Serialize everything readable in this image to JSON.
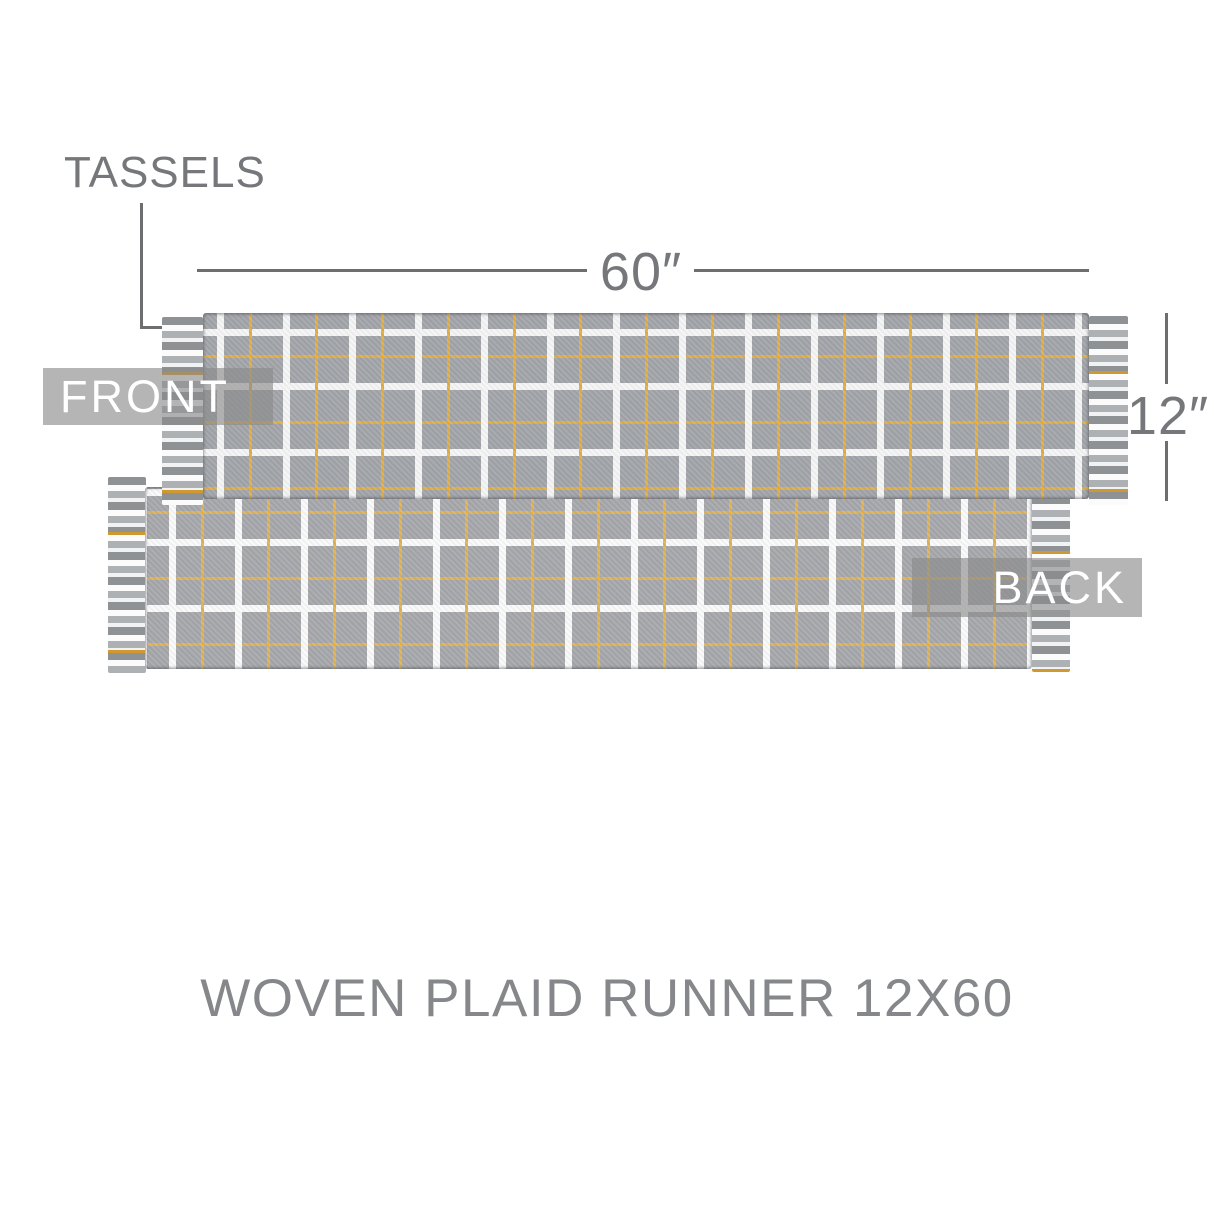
{
  "title": {
    "text": "WOVEN PLAID RUNNER 12X60"
  },
  "annotations": {
    "tassels": {
      "label": "TASSELS"
    },
    "width_dim": {
      "label": "60″"
    },
    "height_dim": {
      "label": "12″"
    },
    "front_badge": {
      "label": "FRONT"
    },
    "back_badge": {
      "label": "BACK"
    }
  },
  "colors": {
    "page_bg": "#ffffff",
    "text_gray": "#75777a",
    "line_gray": "#6c6e70",
    "title_gray": "#85878a",
    "badge_bg": "rgba(138,138,138,0.63)",
    "badge_text": "#ffffff",
    "fabric_gray": "#a2a5a9",
    "plaid_white": "#f5f5f5",
    "plaid_yellow": "#e2ae45",
    "fringe_dark": "#8f9295",
    "fringe_mid": "#aeb1b4",
    "fringe_white": "#fbfbfb",
    "fringe_yellow": "#d0992f"
  }
}
